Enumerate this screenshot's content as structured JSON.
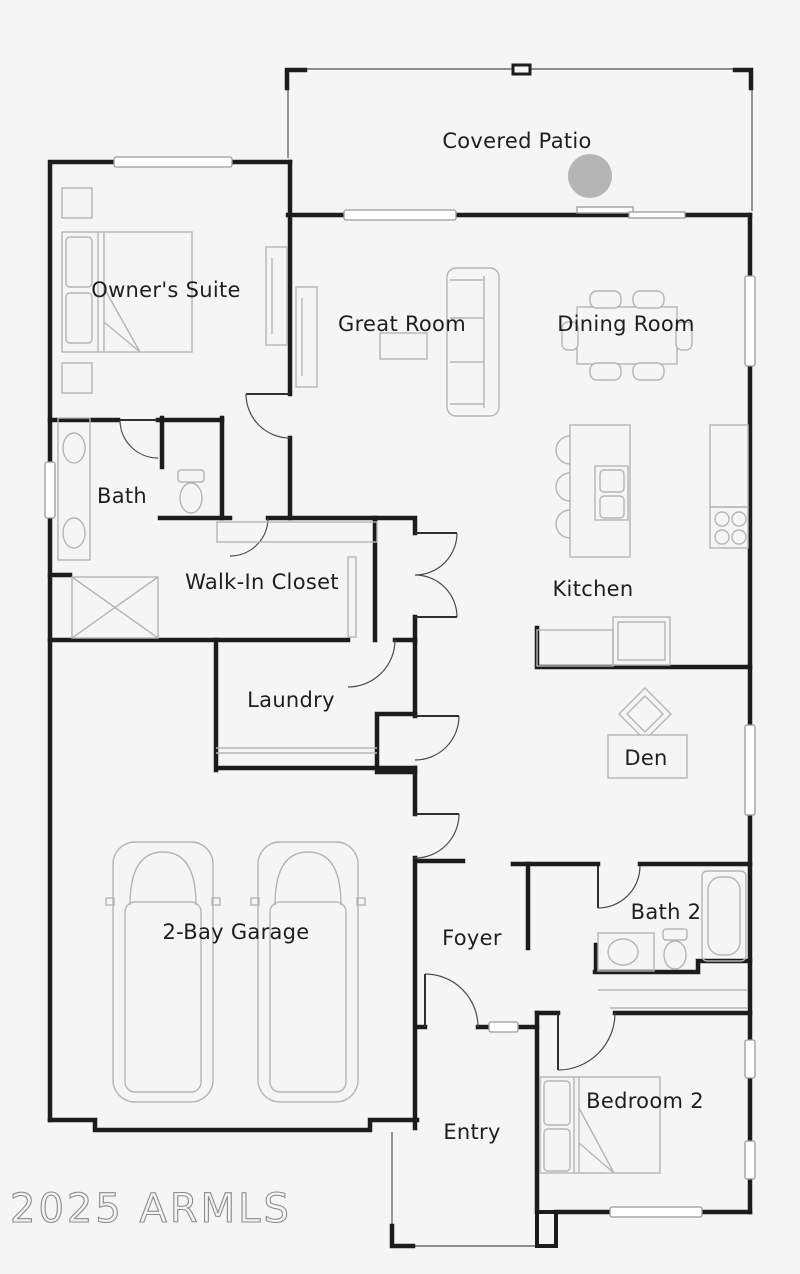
{
  "image_type": "residential-floor-plan",
  "watermark": "2025 ARMLS",
  "colors": {
    "background": "#f5f5f5",
    "wall": "#1c1c1c",
    "furniture_outline": "#b5b5b5",
    "thin_outline": "#6d6d6d",
    "label_text": "#1e1e1e",
    "patio_circle": "#b5b5b5",
    "watermark_stroke": "#8b8b8b"
  },
  "rooms": [
    {
      "id": "covered-patio",
      "label": "Covered Patio"
    },
    {
      "id": "owners-suite",
      "label": "Owner's Suite"
    },
    {
      "id": "great-room",
      "label": "Great Room"
    },
    {
      "id": "dining-room",
      "label": "Dining Room"
    },
    {
      "id": "bath",
      "label": "Bath"
    },
    {
      "id": "walk-in-closet",
      "label": "Walk-In Closet"
    },
    {
      "id": "kitchen",
      "label": "Kitchen"
    },
    {
      "id": "laundry",
      "label": "Laundry"
    },
    {
      "id": "den",
      "label": "Den"
    },
    {
      "id": "garage",
      "label": "2-Bay Garage"
    },
    {
      "id": "foyer",
      "label": "Foyer"
    },
    {
      "id": "bath-2",
      "label": "Bath 2"
    },
    {
      "id": "entry",
      "label": "Entry"
    },
    {
      "id": "bedroom-2",
      "label": "Bedroom 2"
    }
  ],
  "fixtures": [
    "owners-bed",
    "nightstands",
    "dressers",
    "sofa",
    "coffee-table",
    "dining-table-with-chairs",
    "kitchen-island-with-stools",
    "island-sink",
    "refrigerator-counter",
    "cooktop",
    "range",
    "double-vanity",
    "toilet",
    "shower",
    "closet-shelving",
    "laundry-counter",
    "two-cars",
    "desk",
    "desk-chair",
    "bath2-vanity",
    "bath2-toilet",
    "bathtub",
    "closet-rod",
    "bedroom2-bed",
    "patio-column-circle"
  ]
}
